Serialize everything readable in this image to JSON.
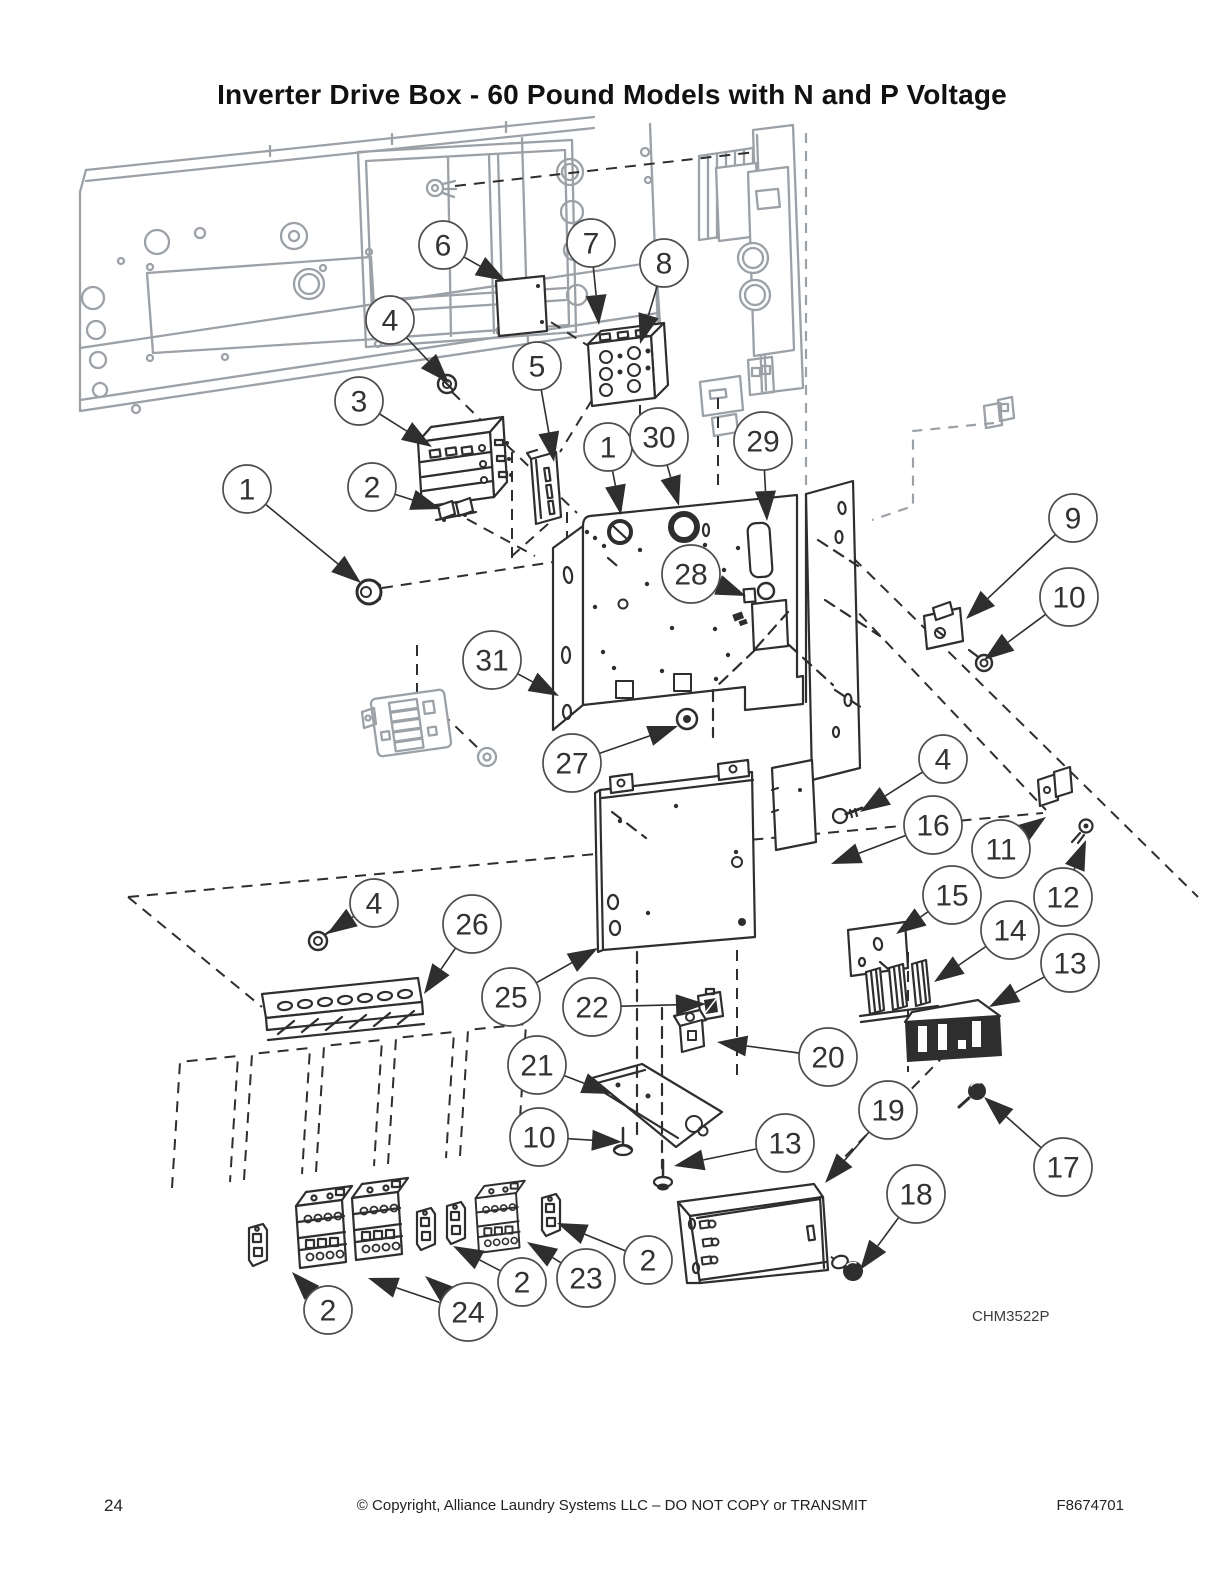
{
  "page": {
    "title": "Inverter Drive Box - 60 Pound Models with N and P Voltage",
    "figure_code": "CHM3522P",
    "page_number": "24",
    "copyright": "© Copyright, Alliance Laundry Systems LLC – DO NOT COPY or TRANSMIT",
    "doc_number": "F8674701"
  },
  "colors": {
    "line": "#2e2e2e",
    "gray": "#9ba1a6",
    "callout_stroke": "#4d4d4d"
  },
  "callouts": [
    {
      "label": "6",
      "cx": 443,
      "cy": 245,
      "targets": [
        [
          506,
          281
        ]
      ]
    },
    {
      "label": "7",
      "cx": 591,
      "cy": 243,
      "targets": [
        [
          599,
          325
        ]
      ]
    },
    {
      "label": "8",
      "cx": 664,
      "cy": 263,
      "targets": [
        [
          640,
          344
        ]
      ]
    },
    {
      "label": "4",
      "cx": 390,
      "cy": 320,
      "targets": [
        [
          449,
          383
        ]
      ]
    },
    {
      "label": "5",
      "cx": 537,
      "cy": 366,
      "targets": [
        [
          554,
          462
        ]
      ]
    },
    {
      "label": "3",
      "cx": 359,
      "cy": 401,
      "targets": [
        [
          432,
          447
        ]
      ]
    },
    {
      "label": "1",
      "cx": 608,
      "cy": 447,
      "targets": [
        [
          621,
          515
        ]
      ]
    },
    {
      "label": "30",
      "cx": 659,
      "cy": 437,
      "targets": [
        [
          679,
          506
        ]
      ]
    },
    {
      "label": "29",
      "cx": 763,
      "cy": 441,
      "targets": [
        [
          767,
          521
        ]
      ]
    },
    {
      "label": "2",
      "cx": 372,
      "cy": 487,
      "targets": [
        [
          441,
          509
        ]
      ]
    },
    {
      "label": "1",
      "cx": 247,
      "cy": 489,
      "targets": [
        [
          361,
          583
        ]
      ]
    },
    {
      "label": "9",
      "cx": 1073,
      "cy": 518,
      "targets": [
        [
          966,
          619
        ]
      ]
    },
    {
      "label": "28",
      "cx": 691,
      "cy": 574,
      "targets": [
        [
          746,
          596
        ]
      ]
    },
    {
      "label": "10",
      "cx": 1069,
      "cy": 597,
      "targets": [
        [
          984,
          660
        ]
      ]
    },
    {
      "label": "31",
      "cx": 492,
      "cy": 660,
      "targets": [
        [
          559,
          696
        ]
      ]
    },
    {
      "label": "27",
      "cx": 572,
      "cy": 763,
      "targets": [
        [
          678,
          726
        ]
      ]
    },
    {
      "label": "4",
      "cx": 943,
      "cy": 759,
      "targets": [
        [
          860,
          812
        ]
      ]
    },
    {
      "label": "16",
      "cx": 933,
      "cy": 825,
      "targets": [
        [
          831,
          864
        ]
      ]
    },
    {
      "label": "11",
      "cx": 1001,
      "cy": 849,
      "targets": [
        [
          1046,
          817
        ]
      ]
    },
    {
      "label": "15",
      "cx": 952,
      "cy": 895,
      "targets": [
        [
          896,
          934
        ]
      ]
    },
    {
      "label": "12",
      "cx": 1063,
      "cy": 897,
      "targets": [
        [
          1086,
          840
        ]
      ]
    },
    {
      "label": "14",
      "cx": 1010,
      "cy": 930,
      "targets": [
        [
          934,
          982
        ]
      ]
    },
    {
      "label": "13",
      "cx": 1070,
      "cy": 963,
      "targets": [
        [
          989,
          1007
        ]
      ]
    },
    {
      "label": "4",
      "cx": 374,
      "cy": 903,
      "targets": [
        [
          327,
          934
        ]
      ]
    },
    {
      "label": "26",
      "cx": 472,
      "cy": 924,
      "targets": [
        [
          424,
          994
        ]
      ]
    },
    {
      "label": "25",
      "cx": 511,
      "cy": 997,
      "targets": [
        [
          598,
          948
        ]
      ]
    },
    {
      "label": "22",
      "cx": 592,
      "cy": 1007,
      "targets": [
        [
          706,
          1004
        ]
      ]
    },
    {
      "label": "20",
      "cx": 828,
      "cy": 1057,
      "targets": [
        [
          717,
          1042
        ]
      ]
    },
    {
      "label": "21",
      "cx": 537,
      "cy": 1065,
      "targets": [
        [
          612,
          1094
        ]
      ]
    },
    {
      "label": "19",
      "cx": 888,
      "cy": 1110,
      "targets": [
        [
          825,
          1183
        ]
      ]
    },
    {
      "label": "10",
      "cx": 539,
      "cy": 1137,
      "targets": [
        [
          622,
          1142
        ]
      ]
    },
    {
      "label": "13",
      "cx": 785,
      "cy": 1143,
      "targets": [
        [
          674,
          1166
        ]
      ]
    },
    {
      "label": "17",
      "cx": 1063,
      "cy": 1167,
      "targets": [
        [
          984,
          1097
        ]
      ]
    },
    {
      "label": "18",
      "cx": 916,
      "cy": 1194,
      "targets": [
        [
          860,
          1270
        ]
      ]
    },
    {
      "label": "2",
      "cx": 648,
      "cy": 1260,
      "targets": [
        [
          557,
          1223
        ]
      ]
    },
    {
      "label": "23",
      "cx": 586,
      "cy": 1278,
      "targets": [
        [
          527,
          1242
        ]
      ]
    },
    {
      "label": "2",
      "cx": 522,
      "cy": 1282,
      "targets": [
        [
          453,
          1246
        ]
      ]
    },
    {
      "label": "24",
      "cx": 468,
      "cy": 1312,
      "targets": [
        [
          368,
          1278
        ],
        [
          425,
          1276
        ]
      ]
    },
    {
      "label": "2",
      "cx": 328,
      "cy": 1310,
      "targets": [
        [
          292,
          1272
        ]
      ]
    }
  ]
}
